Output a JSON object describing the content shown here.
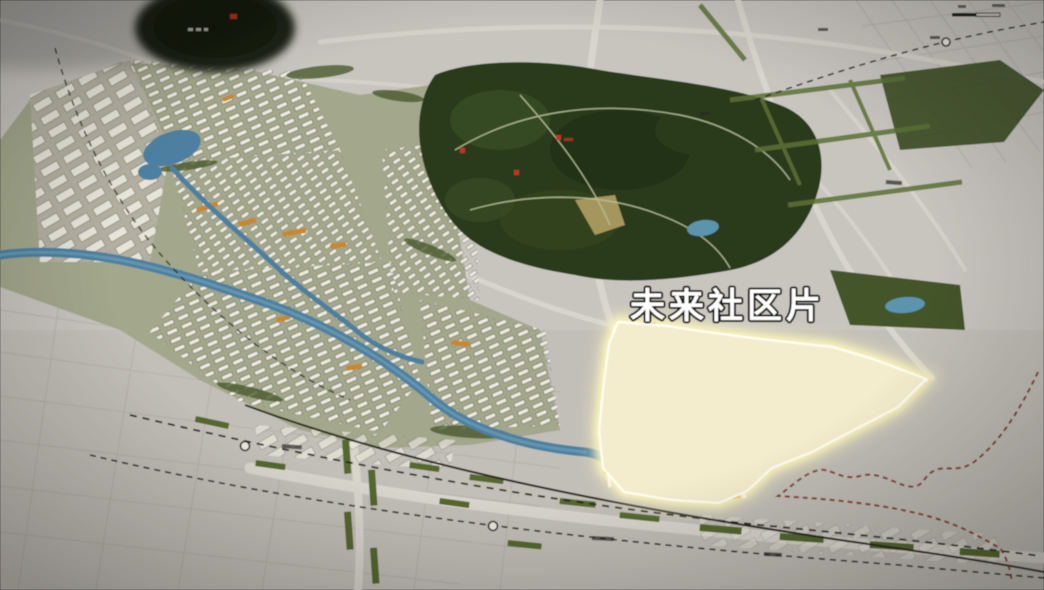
{
  "map": {
    "highlight_label": "未来社区片",
    "colors": {
      "bg": "#c8c5bf",
      "road": "#d8d5cd",
      "fieldline": "#aeaba4",
      "park": "#2c3a1e",
      "park-dark": "#223017",
      "park-light": "#3a4c22",
      "path": "#b9c29a",
      "green": "#5c7136",
      "canal": "#4e80a0",
      "canal-light": "#6fa3bd",
      "bldg": "#edeadf",
      "ground": "#9fa382",
      "orange": "#c8882f",
      "yellow": "#e2bf4a",
      "hl-fill": "#f4edcd",
      "hl-glow": "#fdf6bc",
      "hl-border": "#fffef2",
      "rail": "#26261f",
      "red-boundary": "#7e3020",
      "marker": "#c23524",
      "label": "#ffffff",
      "label-stroke": "#15150f"
    }
  }
}
